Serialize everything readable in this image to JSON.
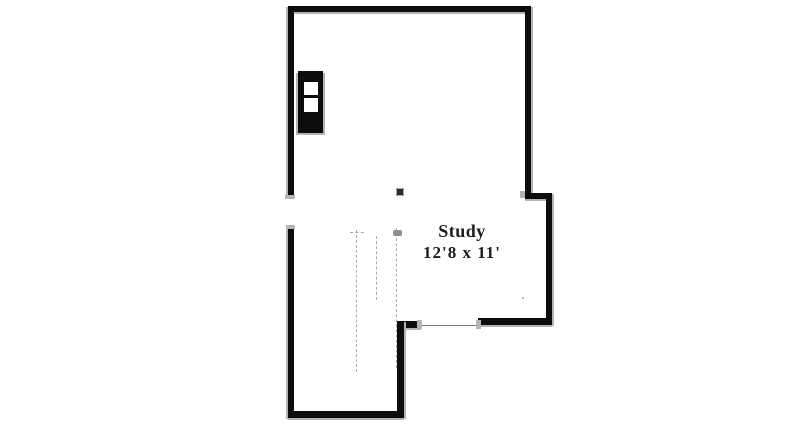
{
  "floor_plan": {
    "room_label": "Study",
    "room_dimensions": "12'8 x 11'",
    "colors": {
      "wall": "#0d0d0d",
      "wall_shadow": "#b4b4b4",
      "dashed_line": "#9c9c9c",
      "opening_line": "#7a7a7a",
      "label_text": "#1c1c1c",
      "background": "#ffffff"
    }
  }
}
